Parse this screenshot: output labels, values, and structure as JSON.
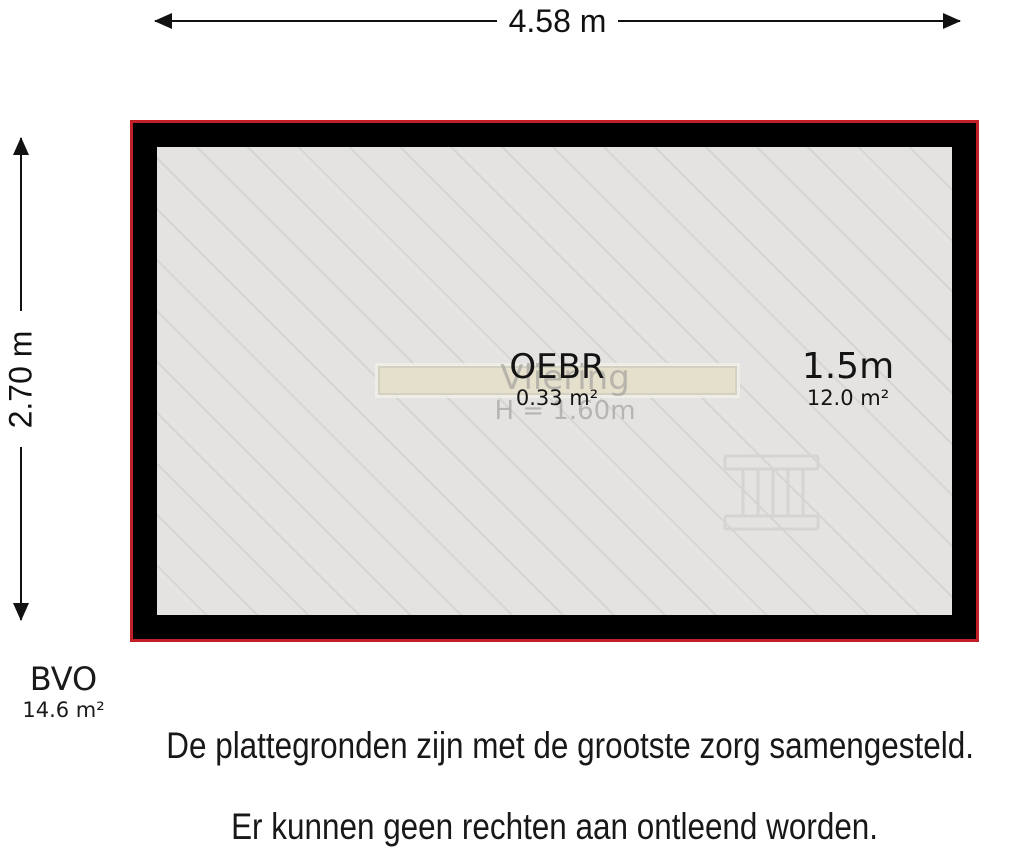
{
  "colors": {
    "outline": "#c22026",
    "wall": "#000000",
    "floor": "#e4e3e1",
    "hatch": "#d6d5d2",
    "beam_fill": "#e5e0cc",
    "beam_border": "#d5d1c2",
    "faded_text": "#a8a6a1",
    "ladder": "#d6d4d1",
    "text": "#1a1a1a"
  },
  "dimensions": {
    "top": "4.58 m",
    "left": "2.70 m"
  },
  "plan": {
    "faded_room": {
      "name": "Vliering",
      "height_note": "H = 1.60m"
    },
    "labels": [
      {
        "title": "OEBR",
        "area": "0.33 m²"
      },
      {
        "title": "1.5m",
        "area": "12.0 m²"
      }
    ]
  },
  "icons": {
    "ladder": "ladder-icon"
  },
  "bvo": {
    "label": "BVO",
    "area": "14.6 m²"
  },
  "disclaimer": {
    "line1": "De plattegronden zijn met de grootste zorg samengesteld.",
    "line2": "Er kunnen geen rechten aan ontleend worden."
  }
}
